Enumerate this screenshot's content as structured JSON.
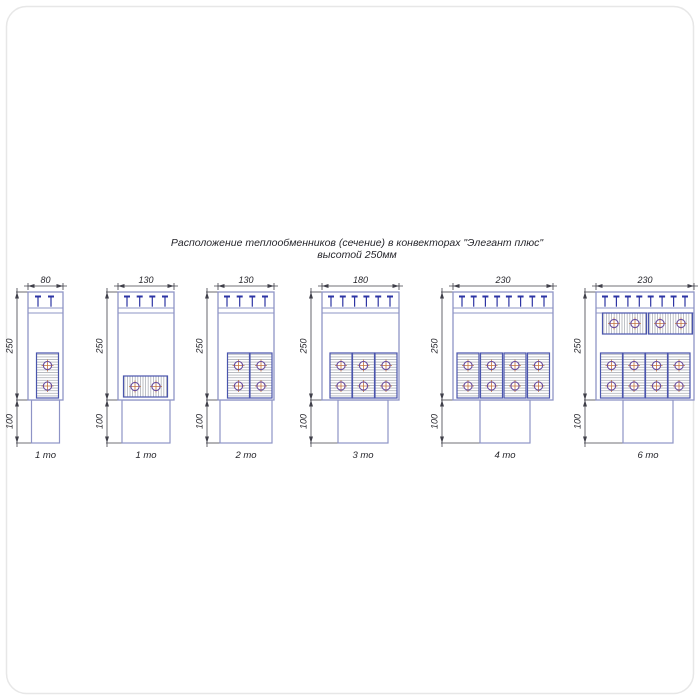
{
  "title": {
    "line1": "Расположение теплообменников (сечение) в конвекторах \"Элегант плюс\"",
    "line2": "высотой 250мм"
  },
  "diagrams": [
    {
      "width": "80",
      "height": "250",
      "duct_height": "100",
      "label": "1 то"
    },
    {
      "width": "130",
      "height": "250",
      "duct_height": "100",
      "label": "1 то"
    },
    {
      "width": "130",
      "height": "250",
      "duct_height": "100",
      "label": "2 то"
    },
    {
      "width": "180",
      "height": "250",
      "duct_height": "100",
      "label": "3 то"
    },
    {
      "width": "230",
      "height": "250",
      "duct_height": "100",
      "label": "4 то"
    },
    {
      "width": "230",
      "height": "250",
      "duct_height": "100",
      "label": "6 то"
    }
  ],
  "colors": {
    "line-blue": "#8e94c6",
    "block-blue": "#4a55ad",
    "navy": "#2c34a4",
    "hatch": "#a0a4ac",
    "tube-ring": "#6a4e9e",
    "tube-cross": "#c2713d",
    "dim": "#40404a",
    "ink": "#26262c"
  }
}
